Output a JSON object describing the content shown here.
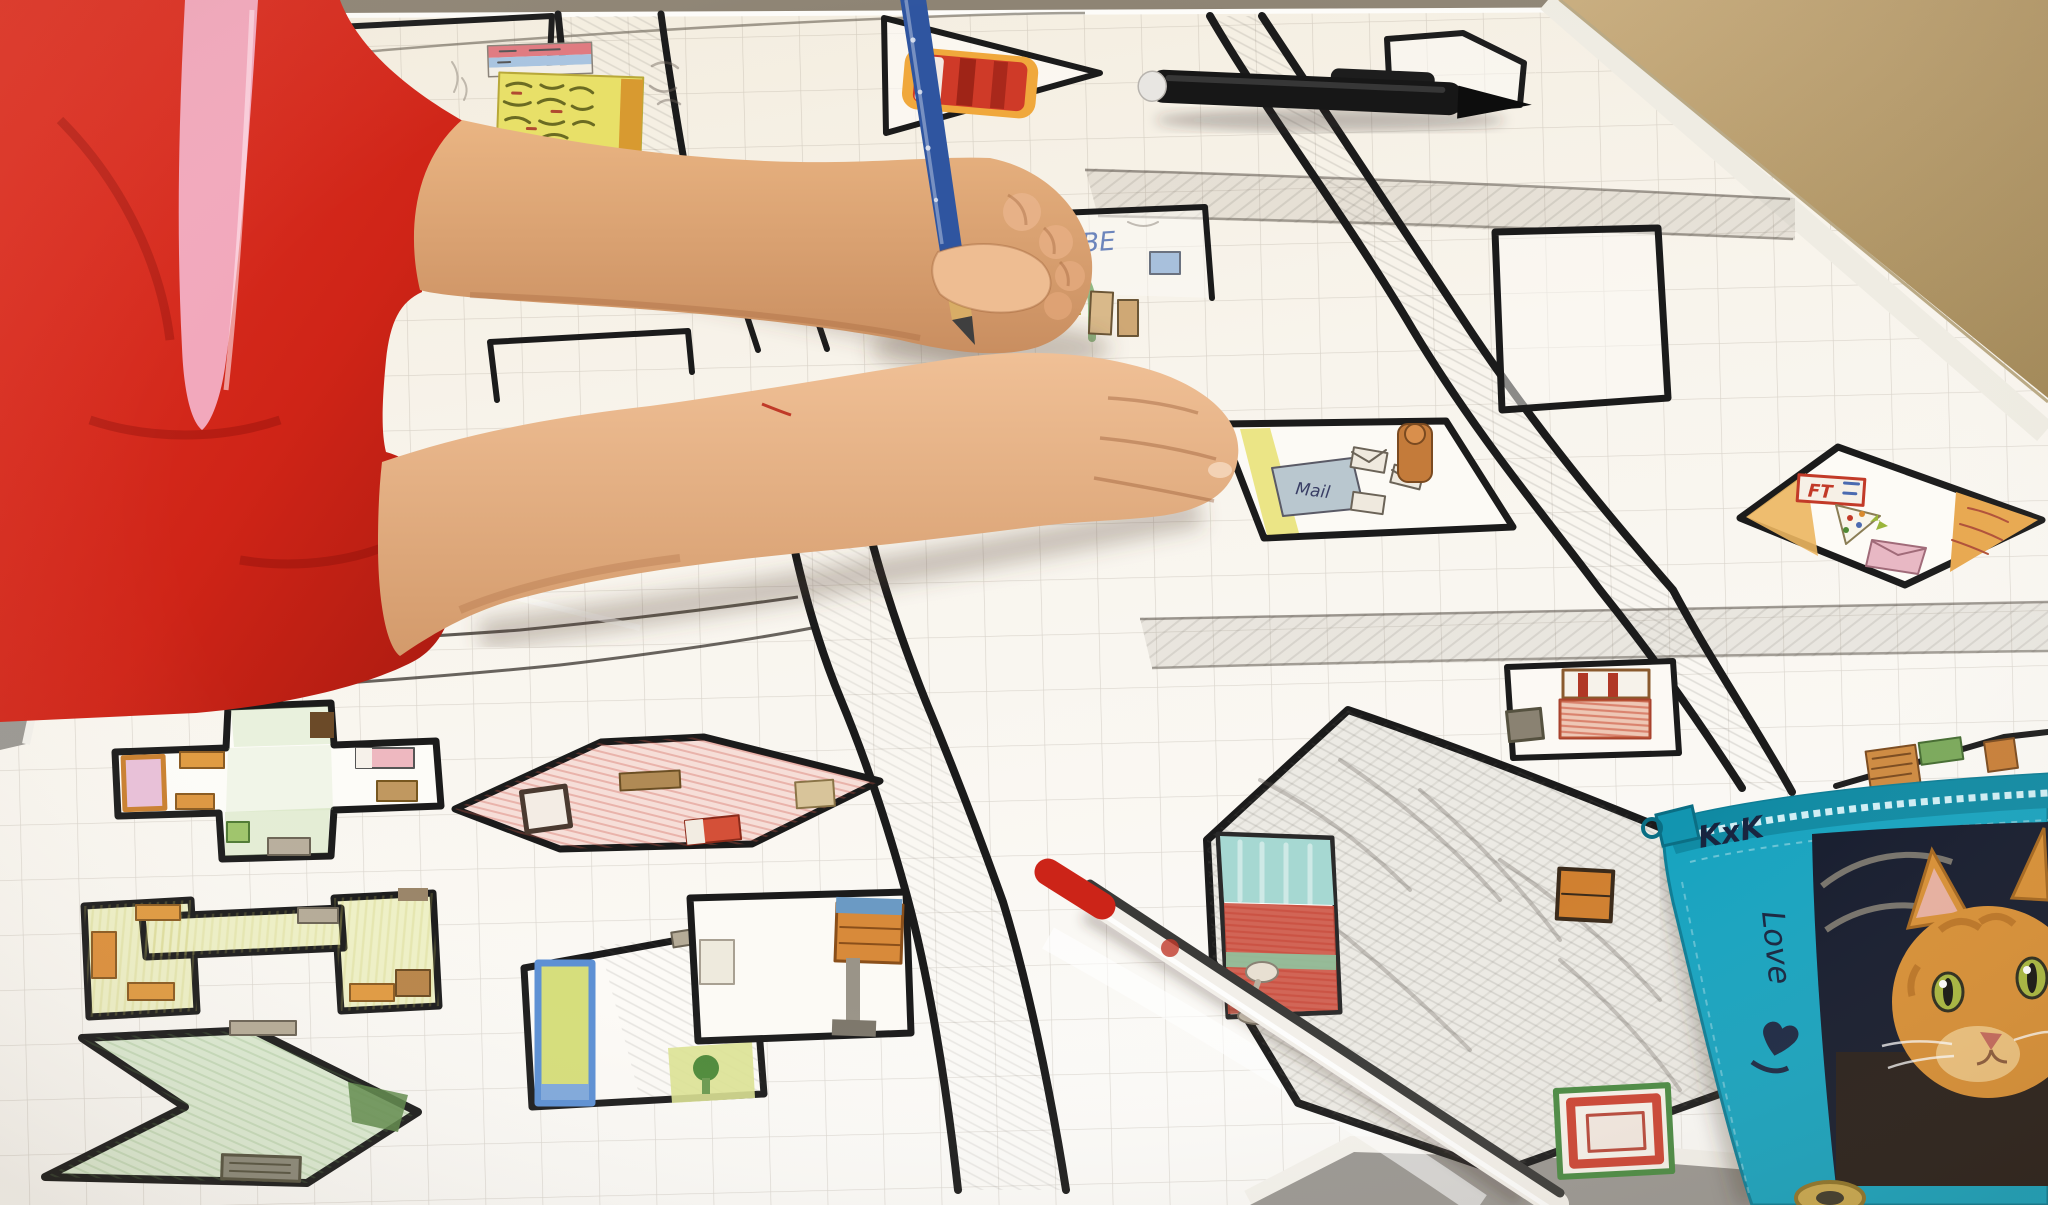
{
  "scene": {
    "description": "Photograph: a child in a red shirt draws a hand-made street map of a town on large graph paper; one hand holds a blue pencil, the other rests flat on the sheet",
    "labels": {
      "mail_sign": "Mail",
      "pencil_case_top": "KxK",
      "pencil_case_side": "Love",
      "building_letters": "BE",
      "diamond_sign": "FT"
    },
    "colors": {
      "shirt_red": "#d62b1e",
      "undershirt_pink": "#f2a8bc",
      "paper": "#f7f2e9",
      "road_black": "#1b1b1b",
      "pencil_blue": "#2f55a0",
      "pen_cap_red": "#cc2418",
      "case_teal": "#17a3bf",
      "table_tan": "#bba06f",
      "table_gray": "#9a9792",
      "kitten_orange": "#d88f34"
    },
    "objects": [
      "graph-paper-map",
      "streets-grid",
      "cross-building",
      "pink-kite-building",
      "u-shape-building",
      "arrow-building",
      "l-shape-building",
      "mail-building",
      "diamond-building",
      "big-house-building",
      "pennant-building",
      "hexagon-building",
      "empty-rectangle-building",
      "bunk-bed-building",
      "child-arms",
      "blue-pencil",
      "black-marker",
      "red-pen",
      "teal-pencil-case",
      "kitten-photo",
      "rug-drawing"
    ]
  }
}
